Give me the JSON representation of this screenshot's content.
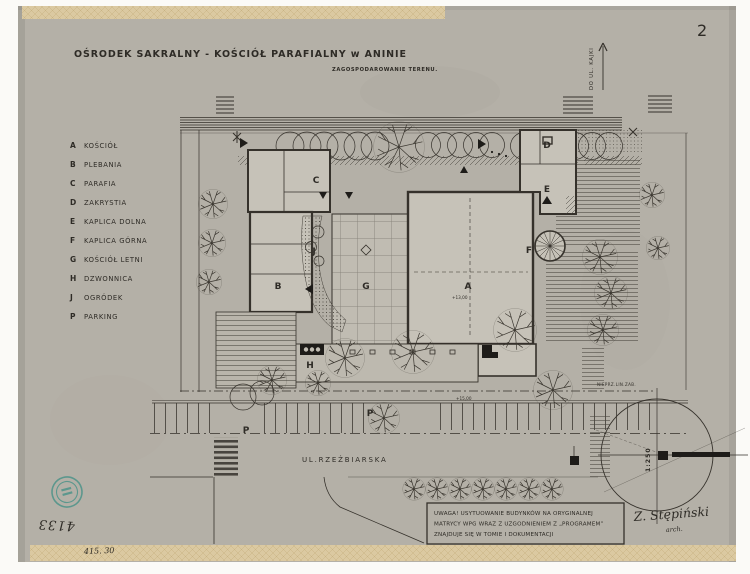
{
  "document": {
    "page_number": "2"
  },
  "title": {
    "main": "OŚRODEK SAKRALNY - KOŚCIÓŁ PARAFIALNY w ANINIE",
    "subtitle": "ZAGOSPODAROWANIE TERENU."
  },
  "legend": {
    "items": [
      {
        "key": "A",
        "label": "KOŚCIÓŁ"
      },
      {
        "key": "B",
        "label": "PLEBANIA"
      },
      {
        "key": "C",
        "label": "PARAFIA"
      },
      {
        "key": "D",
        "label": "ZAKRYSTIA"
      },
      {
        "key": "E",
        "label": "KAPLICA DOLNA"
      },
      {
        "key": "F",
        "label": "KAPLICA GÓRNA"
      },
      {
        "key": "G",
        "label": "KOŚCIÓŁ LETNI"
      },
      {
        "key": "H",
        "label": "DZWONNICA"
      },
      {
        "key": "J",
        "label": "OGRÓDEK"
      },
      {
        "key": "P",
        "label": "PARKING"
      }
    ]
  },
  "plan": {
    "street_top_label": "DO UL. KAJKI",
    "street_bottom_label": "UL.RZEŹBIARSKA",
    "building_line_label": "NIEPRZ.LIN.ZAB.",
    "scale_label": "1:250",
    "elevation_upper": "+13,00",
    "elevation_lower": "+15,00",
    "markers": {
      "A": "A",
      "B": "B",
      "C": "C",
      "D": "D",
      "E": "E",
      "F": "F",
      "G": "G",
      "H": "H",
      "J": "J",
      "P1": "P",
      "P2": "P"
    }
  },
  "note": {
    "line1": "UWAGA! USYTUOWANIE BUDYNKÓW NA ORYGINALNEJ",
    "line2": "MATRYCY WPG WRAZ Z UZGODNIENIEM Z „PROGRAMEM”",
    "line3": "ZNAJDUJE SIĘ W TOMIE I DOKUMENTACJI"
  },
  "signature": {
    "name": "Z. Stępiński",
    "role": "arch."
  },
  "handwritten": {
    "inventory_number": "4133",
    "margin_note": "415. 30"
  },
  "colors": {
    "paper": "#b4b0a7",
    "ink": "#35312b",
    "tape": "#d8c7a0",
    "stamp": "#3f8f85"
  }
}
